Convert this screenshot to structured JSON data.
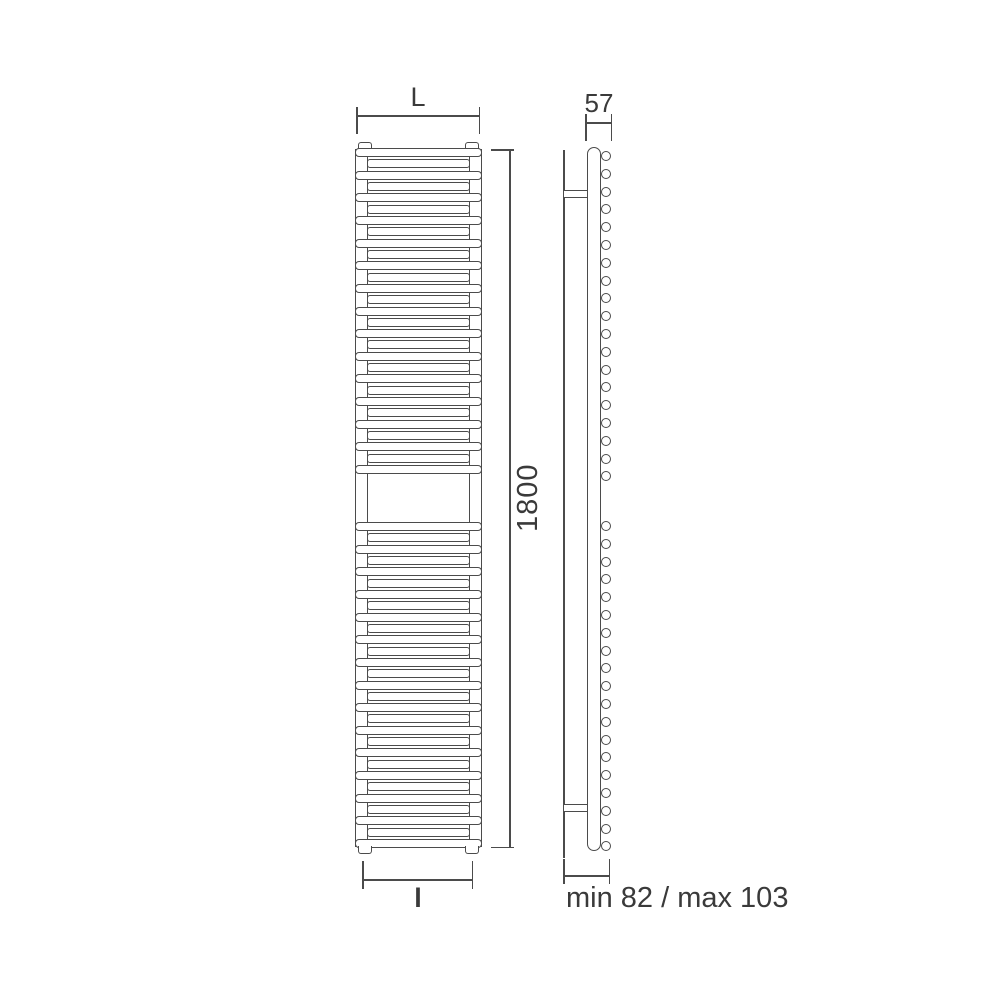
{
  "diagram": {
    "title": "towel-radiator-technical-drawing",
    "background_color": "#ffffff",
    "line_color": "#4b4b4b",
    "text_color": "#3a3a3a",
    "front_view": {
      "description": "front elevation of ladder towel radiator with central gap",
      "sections": [
        {
          "name": "upper-bank",
          "bar_count": 29
        },
        {
          "name": "lower-bank",
          "bar_count": 29
        }
      ]
    },
    "side_view": {
      "description": "side elevation with wall fixing bracket and tube ends",
      "tube_end_count_upper": 19,
      "tube_end_count_lower": 19
    },
    "dimensions": {
      "overall_width_label": "L",
      "overall_height_label": "1800",
      "depth_label": "57",
      "connection_width_label": "l",
      "wall_distance_label": "min 82 / max 103"
    }
  }
}
